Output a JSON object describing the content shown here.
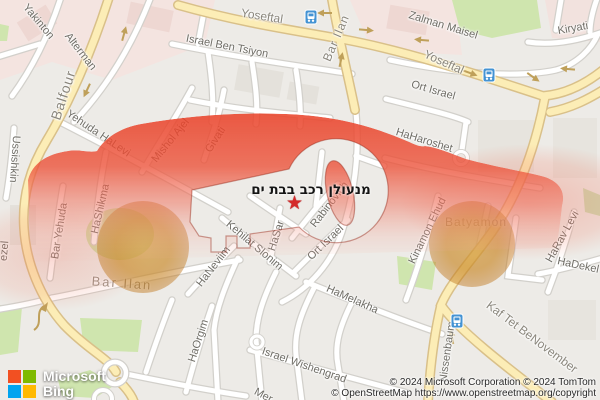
{
  "map": {
    "overlay": {
      "title": "מנעולן רכב בבת ים",
      "marker": "★"
    },
    "logo": {
      "brand": "Microsoft",
      "product": "Bing"
    },
    "attribution": {
      "line1": "© 2024 Microsoft Corporation © 2024 TomTom",
      "line2": "© OpenStreetMap https://www.openstreetmap.org/copyright"
    },
    "streets": [
      {
        "text": "Yakinton",
        "x": 38,
        "y": 22,
        "rot": 50
      },
      {
        "text": "Alterman",
        "x": 80,
        "y": 52,
        "rot": 52
      },
      {
        "text": "Balfour",
        "x": 63,
        "y": 95,
        "rot": -72,
        "size": 14,
        "color": "#8a867c",
        "spacing": 1
      },
      {
        "text": "Israel Ben Tsiyon",
        "x": 227,
        "y": 47,
        "rot": 11
      },
      {
        "text": "Yoseftal",
        "x": 262,
        "y": 16,
        "rot": 9,
        "size": 12,
        "color": "#8a867c"
      },
      {
        "text": "Bar Ilan",
        "x": 336,
        "y": 38,
        "rot": -67,
        "size": 12,
        "color": "#8a867c",
        "spacing": 1
      },
      {
        "text": "Zalman Maisel",
        "x": 443,
        "y": 26,
        "rot": 17
      },
      {
        "text": "Kiryati",
        "x": 573,
        "y": 29,
        "rot": -10
      },
      {
        "text": "Yoseftal",
        "x": 444,
        "y": 62,
        "rot": 24,
        "size": 12,
        "color": "#8a867c"
      },
      {
        "text": "Ort Israel",
        "x": 433,
        "y": 91,
        "rot": 16
      },
      {
        "text": "HaHaroshet",
        "x": 424,
        "y": 141,
        "rot": 17
      },
      {
        "text": "Ussishkin",
        "x": 14,
        "y": 159,
        "rot": 94
      },
      {
        "text": "Yehuda HaLevi",
        "x": 98,
        "y": 134,
        "rot": 34
      },
      {
        "text": "Mishol Ajel",
        "x": 171,
        "y": 141,
        "rot": -51
      },
      {
        "text": "Givati",
        "x": 216,
        "y": 140,
        "rot": -57
      },
      {
        "text": "HaShikma",
        "x": 101,
        "y": 209,
        "rot": -77
      },
      {
        "text": "Bar Yehuda",
        "x": 60,
        "y": 231,
        "rot": -81
      },
      {
        "text": "HaSar",
        "x": 277,
        "y": 236,
        "rot": -72
      },
      {
        "text": "Rabinovich",
        "x": 330,
        "y": 205,
        "rot": -52
      },
      {
        "text": "Ort Israel",
        "x": 326,
        "y": 243,
        "rot": -44
      },
      {
        "text": "Kehilat Slonim",
        "x": 254,
        "y": 246,
        "rot": 40
      },
      {
        "text": "HaNeviim",
        "x": 214,
        "y": 267,
        "rot": -52
      },
      {
        "text": "Kinamon Ehud",
        "x": 428,
        "y": 231,
        "rot": -64
      },
      {
        "text": "Batyamon",
        "x": 476,
        "y": 222,
        "rot": 0,
        "size": 12,
        "color": "#9a9186",
        "spacing": 1
      },
      {
        "text": "HaRav Levi",
        "x": 563,
        "y": 237,
        "rot": -61
      },
      {
        "text": "HaDekel",
        "x": 578,
        "y": 266,
        "rot": 12
      },
      {
        "text": "HaMelakha",
        "x": 352,
        "y": 300,
        "rot": 24
      },
      {
        "text": "Kaf Tet BeNovember",
        "x": 532,
        "y": 337,
        "rot": 37,
        "size": 12,
        "color": "#8a867c"
      },
      {
        "text": "Nissenbaum",
        "x": 448,
        "y": 352,
        "rot": -82
      },
      {
        "text": "Bar Ilan",
        "x": 122,
        "y": 283,
        "rot": 4,
        "size": 13,
        "color": "#9a9186",
        "spacing": 2
      },
      {
        "text": "HaOrgim",
        "x": 199,
        "y": 341,
        "rot": -72
      },
      {
        "text": "Israel Wishengrad",
        "x": 304,
        "y": 366,
        "rot": 19
      },
      {
        "text": "Mer",
        "x": 263,
        "y": 396,
        "rot": 28
      },
      {
        "text": "ezel",
        "x": 5,
        "y": 251,
        "rot": -85
      }
    ],
    "transit_stops": [
      {
        "name": "transit-station",
        "x": 311,
        "y": 17
      },
      {
        "name": "transit-station",
        "x": 489,
        "y": 75
      },
      {
        "name": "transit-station",
        "x": 457,
        "y": 321
      }
    ],
    "colors": {
      "overlay_red": "#e84327",
      "wheel_amber": "#c28a2a",
      "road_major_fill": "#fcedb6",
      "road_casing": "#d9c089",
      "park_green": "#cfe5ae",
      "transit_blue": "#4493d3",
      "star_red": "#d42a2a",
      "pink_zone": "#f4e4e0"
    }
  }
}
